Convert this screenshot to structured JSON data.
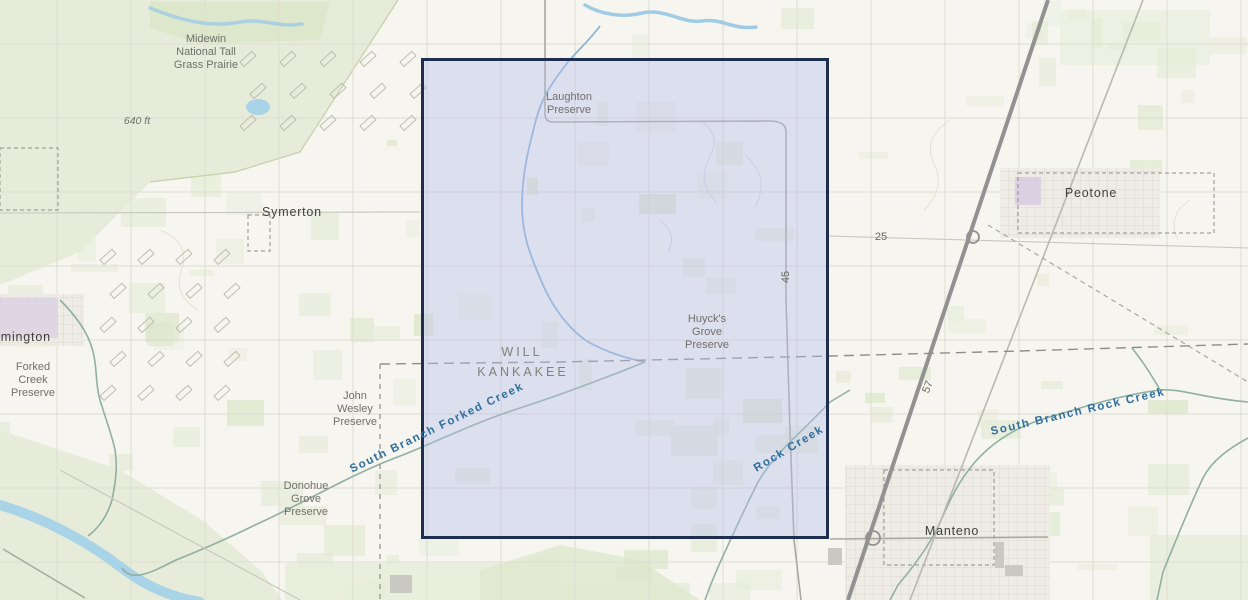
{
  "colors": {
    "land": "#f6f5ef",
    "vegetation": "#e6ecd9",
    "vegetation_strong": "#dde7cb",
    "water_fill": "#a9d3e6",
    "stream_blue": "#9fcbe4",
    "creek_teal": "#8fb0a2",
    "grid_line": "#deddd2",
    "road_minor": "#c7c6bc",
    "road_gray": "#a9a8a0",
    "highway": "#929292",
    "railroad": "#b9b8b0",
    "county_line": "#8e8e85",
    "selection_fill": "rgba(183,191,235,0.40)",
    "selection_border": "#1d2e4f",
    "urban_fill": "#eeece5",
    "urban_purple": "#d9d1e2",
    "label_preserve": "#70706a",
    "label_town": "#3f3f3b",
    "label_county": "#81817a",
    "label_creek": "#2f6f9d",
    "label_route": "#6a6a64"
  },
  "selection": {
    "x": 421,
    "y": 58,
    "width": 408,
    "height": 481
  },
  "labels": [
    {
      "id": "midewin-national-tall-grass-prairie",
      "text": "Midewin\nNational Tall\nGrass Prairie",
      "x": 206,
      "y": 53,
      "cls": "preserve"
    },
    {
      "id": "elevation-640-ft",
      "text": "640 ft",
      "x": 137,
      "y": 121,
      "cls": "elev"
    },
    {
      "id": "town-symerton",
      "text": "Symerton",
      "x": 292,
      "y": 212,
      "cls": "town"
    },
    {
      "id": "laughton-preserve",
      "text": "Laughton\nPreserve",
      "x": 569,
      "y": 104,
      "cls": "preserve"
    },
    {
      "id": "huycks-grove-preserve",
      "text": "Huyck's\nGrove\nPreserve",
      "x": 707,
      "y": 333,
      "cls": "preserve"
    },
    {
      "id": "county-will",
      "text": "WILL",
      "x": 522,
      "y": 352,
      "cls": "county"
    },
    {
      "id": "county-kankakee",
      "text": "KANKAKEE",
      "x": 523,
      "y": 372,
      "cls": "county"
    },
    {
      "id": "john-wesley-preserve",
      "text": "John\nWesley\nPreserve",
      "x": 355,
      "y": 410,
      "cls": "preserve"
    },
    {
      "id": "donohue-grove-preserve",
      "text": "Donohue\nGrove\nPreserve",
      "x": 306,
      "y": 500,
      "cls": "preserve"
    },
    {
      "id": "forked-creek-preserve",
      "text": "Forked\nCreek\nPreserve",
      "x": 33,
      "y": 381,
      "cls": "preserve"
    },
    {
      "id": "town-wilmington-clipped",
      "text": "lmington",
      "x": 24,
      "y": 337,
      "cls": "town"
    },
    {
      "id": "town-peotone",
      "text": "Peotone",
      "x": 1091,
      "y": 193,
      "cls": "town"
    },
    {
      "id": "town-manteno",
      "text": "Manteno",
      "x": 952,
      "y": 531,
      "cls": "town"
    },
    {
      "id": "route-25",
      "text": "25",
      "x": 881,
      "y": 237,
      "cls": "route"
    },
    {
      "id": "route-45",
      "text": "45",
      "x": 786,
      "y": 277,
      "cls": "route",
      "rotate": -90
    },
    {
      "id": "route-57",
      "text": "57",
      "x": 928,
      "y": 387,
      "cls": "route",
      "rotate": -68
    },
    {
      "id": "creek-south-branch-forked",
      "text": "South Branch Forked Creek",
      "x": 437,
      "y": 428,
      "cls": "creek",
      "rotate": -26
    },
    {
      "id": "creek-rock",
      "text": "Rock Creek",
      "x": 789,
      "y": 449,
      "cls": "creek",
      "rotate": -31
    },
    {
      "id": "creek-south-branch-rock",
      "text": "South Branch Rock Creek",
      "x": 1078,
      "y": 412,
      "cls": "creek",
      "rotate": -13
    }
  ]
}
